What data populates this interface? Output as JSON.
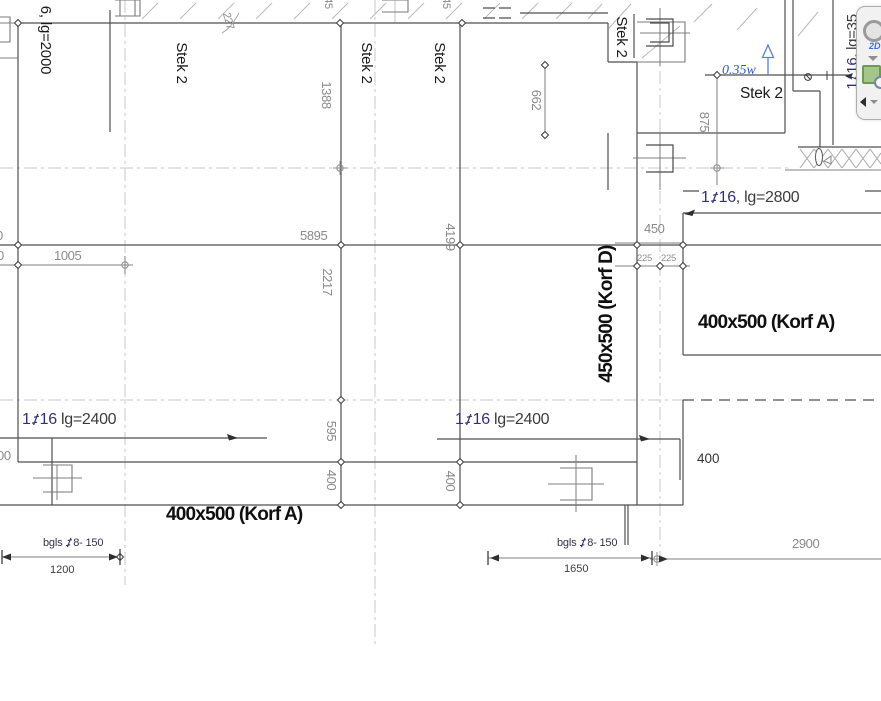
{
  "labels": {
    "stek": "Stek 2",
    "korf_a": "400x500  (Korf A)",
    "korf_d": "450x500  (Korf D)",
    "level": "0.35w"
  },
  "rebar": {
    "left": {
      "count": "1",
      "bar": "16",
      "len": "lg=2400"
    },
    "mid": {
      "count": "1",
      "bar": "16",
      "len": "lg=2400"
    },
    "right": {
      "count": "1",
      "bar": "16,",
      "len": "lg=2800"
    },
    "vertical": {
      "count": "1",
      "bar": "16,",
      "len": "lg=35"
    },
    "top_left_cut": "6, lg=2000",
    "stirrup_left": {
      "prefix": "bgls",
      "spec": "8- 150"
    },
    "stirrup_mid": {
      "prefix": "bgls",
      "spec": "8- 150"
    }
  },
  "dimensions": {
    "h5895": "5895",
    "h1005": "1005",
    "h450": "450",
    "h225l": "225",
    "h225r": "225",
    "h2900": "2900",
    "h1200": "1200",
    "h1650": "1650",
    "v1388": "1388",
    "v2217": "2217",
    "v595": "595",
    "v400l": "400",
    "v400m": "400",
    "v4199": "4199",
    "v662": "662",
    "v875": "875",
    "d227": "227",
    "w400": "400",
    "cut_45a": "45",
    "cut_45b": "45",
    "cut_0a": "0",
    "cut_0b": "0",
    "cut_00": "00"
  },
  "toolbar": {
    "label_2d": "2D"
  }
}
